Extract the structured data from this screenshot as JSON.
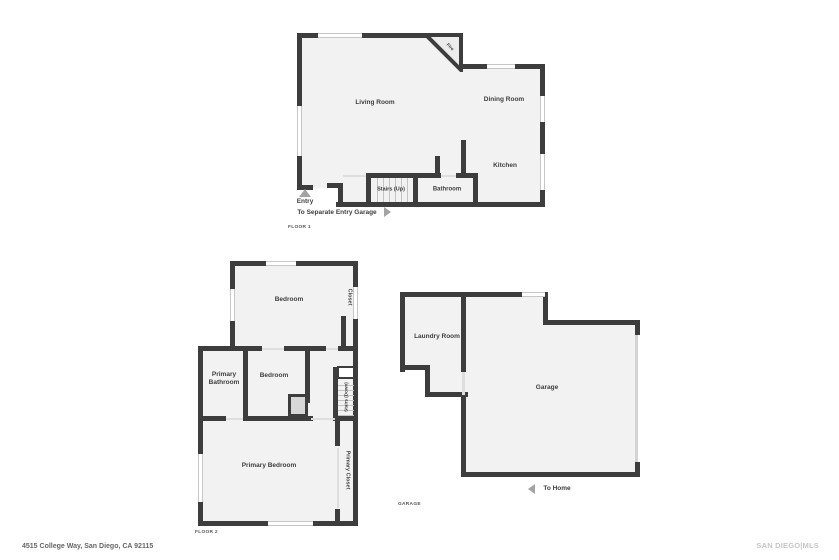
{
  "colors": {
    "wall": "#3d3d3d",
    "room_fill": "#f2f2f2",
    "window": "#c7c7c7",
    "label_text": "#3e3e3e",
    "arrow": "#a3a3a3",
    "muted_text": "#666666",
    "watermark": "#c6c6c6"
  },
  "floor1": {
    "name_label": "FLOOR 1",
    "rooms": {
      "living_room": "Living Room",
      "dining_room": "Dining Room",
      "kitchen": "Kitchen",
      "bathroom": "Bathroom",
      "stairs": "Stairs (Up)",
      "fireplace": "Fire"
    },
    "entry_label": "Entry",
    "separate_entry_label": "To Separate Entry Garage"
  },
  "floor2": {
    "name_label": "FLOOR 2",
    "rooms": {
      "bedroom_top": "Bedroom",
      "closet": "Closet",
      "primary_bathroom": "Primary Bathroom",
      "bedroom_mid": "Bedroom",
      "stairs": "Stairs (Down)",
      "primary_bedroom": "Primary Bedroom",
      "primary_closet": "Primary Closet"
    }
  },
  "garage": {
    "name_label": "GARAGE",
    "rooms": {
      "laundry": "Laundry Room",
      "garage": "Garage"
    },
    "to_home_label": "To Home"
  },
  "footer": {
    "address": "4515 College Way, San Diego, CA 92115",
    "watermark": "SAN DIEGO|MLS"
  }
}
